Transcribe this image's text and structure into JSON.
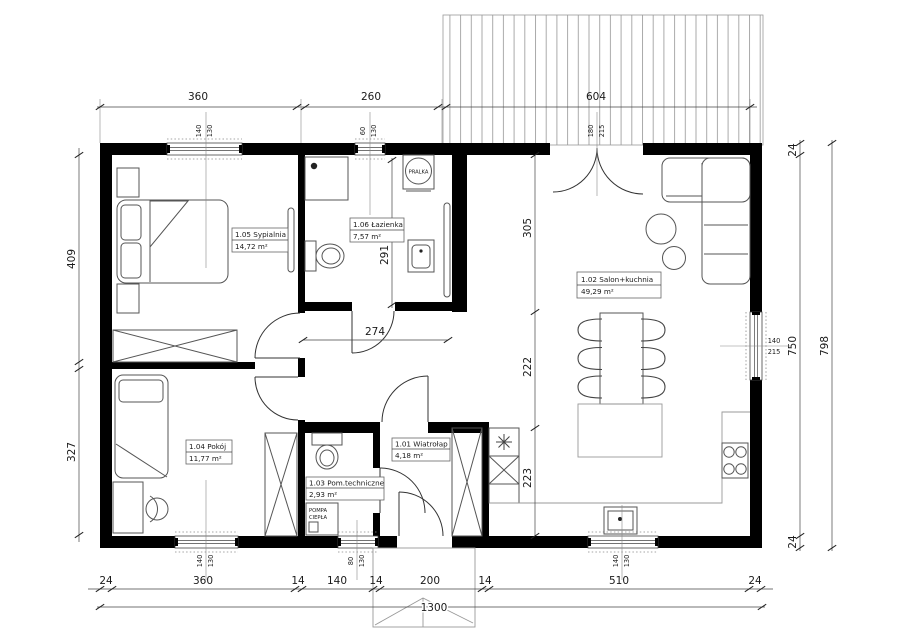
{
  "plan": {
    "rooms": [
      {
        "name": "1.05 Sypialnia",
        "area": "14,72 m²"
      },
      {
        "name": "1.06 Łazienka",
        "area": "7,57 m²"
      },
      {
        "name": "1.02 Salon+kuchnia",
        "area": "49,29 m²"
      },
      {
        "name": "1.04 Pokój",
        "area": "11,77 m²"
      },
      {
        "name": "1.03 Pom.techniczne",
        "area": "2,93 m²"
      },
      {
        "name": "1.01 Wiatrołap",
        "area": "4,18 m²"
      }
    ],
    "appliances": {
      "washer": "PRALKA",
      "heat_pump_line1": "POMPA",
      "heat_pump_line2": "CIEPŁA"
    },
    "dims": {
      "top": [
        "360",
        "260",
        "604"
      ],
      "bottom": [
        "24",
        "360",
        "14",
        "140",
        "14",
        "200",
        "14",
        "510",
        "24"
      ],
      "bottom_total": "1300",
      "left": [
        "409",
        "327"
      ],
      "right": [
        "24",
        "750",
        "24",
        "798"
      ],
      "interior": {
        "hall_width": "274",
        "bath_height": "291",
        "salon_top": "305",
        "salon_mid": "222",
        "salon_bottom": "223"
      }
    },
    "windows": {
      "bedroom_top": [
        "140",
        "130"
      ],
      "bath_top": [
        "60",
        "130"
      ],
      "terrace_door": [
        "180",
        "215"
      ],
      "salon_east": [
        "140",
        "215"
      ],
      "pokoj_bottom": [
        "140",
        "130"
      ],
      "tech_bottom": [
        "80",
        "130"
      ],
      "salon_bottom": [
        "140",
        "130"
      ]
    }
  }
}
